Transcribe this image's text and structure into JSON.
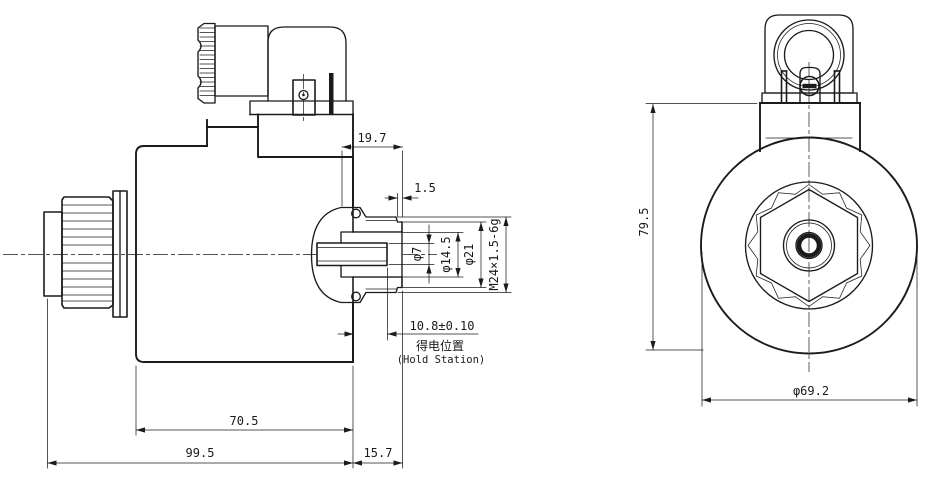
{
  "drawing": {
    "side_view": {
      "dims": {
        "offset_19_7": "19.7",
        "groove_1_5": "1.5",
        "pin_dia": "φ7",
        "bore_dia": "φ14.5",
        "neck_dia": "φ21",
        "thread_spec": "M24×1.5-6g",
        "hold_pos": "10.8±0.10",
        "hold_cn": "得电位置",
        "hold_en": "(Hold Station)",
        "len_70_5": "70.5",
        "len_99_5": "99.5",
        "len_15_7": "15.7"
      }
    },
    "front_view": {
      "dims": {
        "height_79_5": "79.5",
        "dia_69_2": "φ69.2"
      }
    }
  }
}
